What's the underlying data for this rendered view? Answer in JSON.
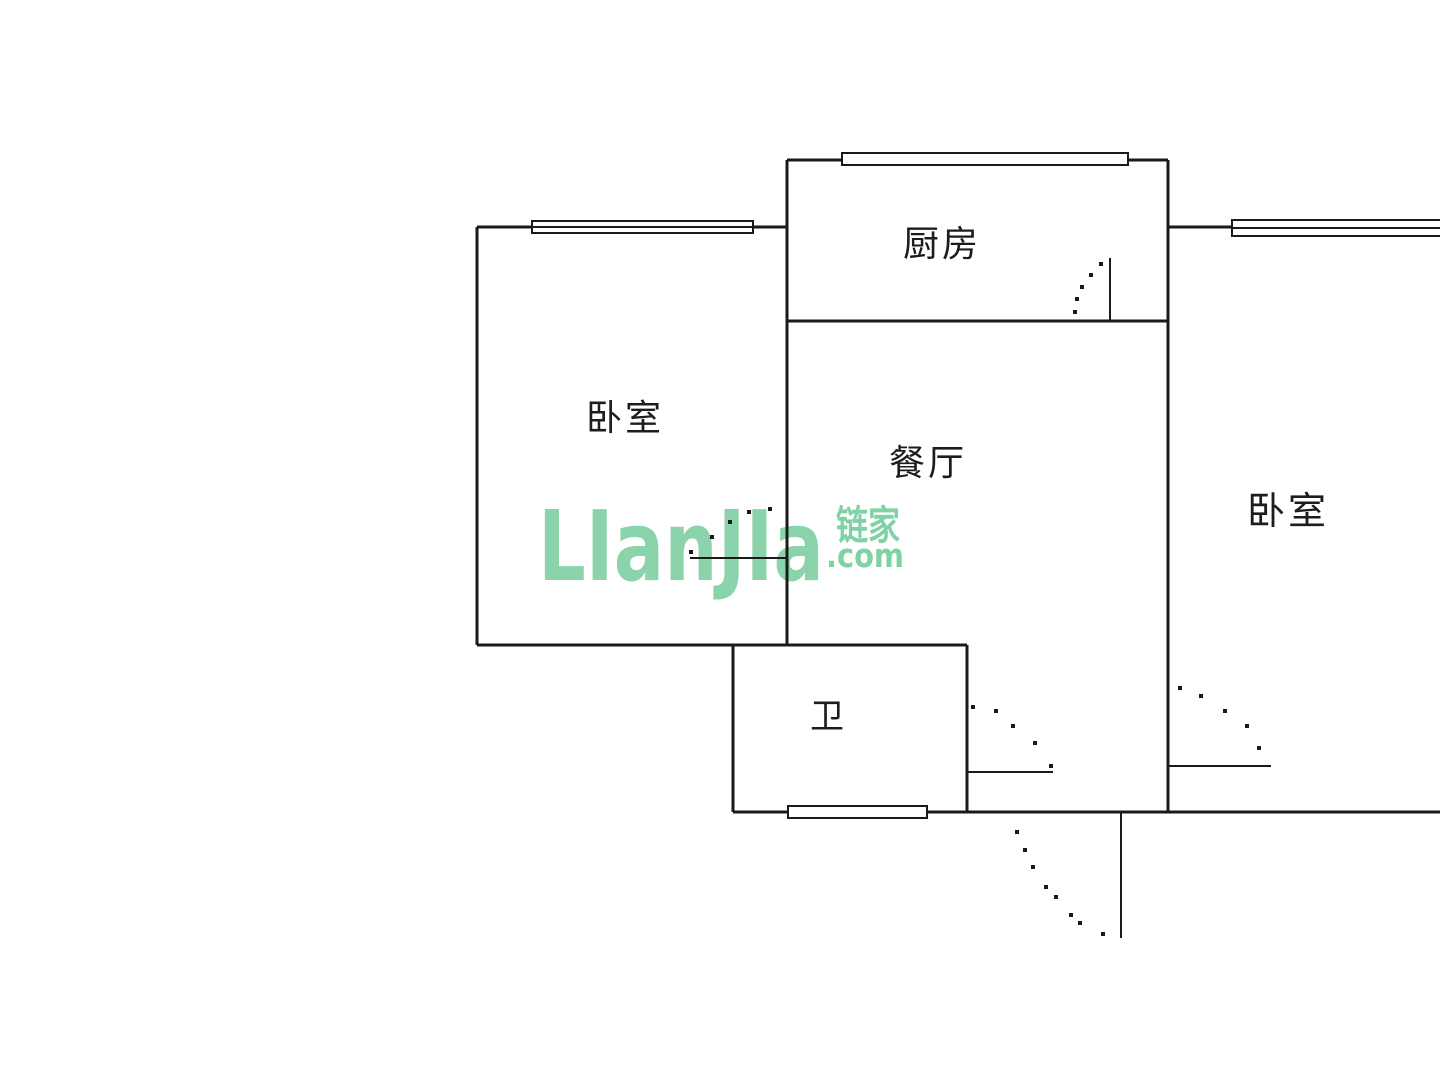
{
  "canvas": {
    "width": 1440,
    "height": 1080,
    "background": "#ffffff",
    "line_color": "#1a1a1a",
    "wall_stroke": 3,
    "window_stroke": 2,
    "door_stroke": 2,
    "dot_size": 4
  },
  "rooms": [
    {
      "id": "kitchen",
      "label": "厨房"
    },
    {
      "id": "bedroom-left",
      "label": "卧室"
    },
    {
      "id": "dining",
      "label": "餐厅"
    },
    {
      "id": "bedroom-right",
      "label": "卧室"
    },
    {
      "id": "bathroom",
      "label": "卫"
    }
  ],
  "walls": [
    {
      "x1": 787,
      "y1": 160,
      "x2": 1168,
      "y2": 160
    },
    {
      "x1": 477,
      "y1": 227,
      "x2": 787,
      "y2": 227
    },
    {
      "x1": 1168,
      "y1": 227,
      "x2": 1440,
      "y2": 227
    },
    {
      "x1": 787,
      "y1": 321,
      "x2": 1168,
      "y2": 321
    },
    {
      "x1": 477,
      "y1": 645,
      "x2": 967,
      "y2": 645
    },
    {
      "x1": 733,
      "y1": 812,
      "x2": 1440,
      "y2": 812
    },
    {
      "x1": 477,
      "y1": 227,
      "x2": 477,
      "y2": 645
    },
    {
      "x1": 787,
      "y1": 160,
      "x2": 787,
      "y2": 645
    },
    {
      "x1": 1168,
      "y1": 160,
      "x2": 1168,
      "y2": 812
    },
    {
      "x1": 733,
      "y1": 645,
      "x2": 733,
      "y2": 812
    },
    {
      "x1": 967,
      "y1": 645,
      "x2": 967,
      "y2": 812
    }
  ],
  "windows": [
    {
      "id": "kitchen-window",
      "x": 842,
      "cy": 159,
      "w": 286,
      "hh": 6,
      "mid": false
    },
    {
      "id": "bedroom-left-window",
      "x": 532,
      "cy": 227,
      "w": 221,
      "hh": 6,
      "mid": true
    },
    {
      "id": "bedroom-right-window",
      "x": 1232,
      "cy": 228,
      "w": 210,
      "hh": 8,
      "mid": true
    },
    {
      "id": "bathroom-window",
      "x": 788,
      "cy": 812,
      "w": 139,
      "hh": 6,
      "mid": false
    }
  ],
  "doors": [
    {
      "id": "bedroom-left-door",
      "leaf": {
        "x1": 690,
        "y1": 558,
        "x2": 787,
        "y2": 558
      },
      "dots": [
        [
          691,
          552
        ],
        [
          712,
          537
        ],
        [
          730,
          522
        ],
        [
          749,
          512
        ],
        [
          770,
          509
        ]
      ]
    },
    {
      "id": "kitchen-door",
      "leaf": {
        "x1": 1110,
        "y1": 258,
        "x2": 1110,
        "y2": 321
      },
      "dots": [
        [
          1101,
          264
        ],
        [
          1091,
          275
        ],
        [
          1082,
          287
        ],
        [
          1077,
          299
        ],
        [
          1075,
          312
        ]
      ]
    },
    {
      "id": "bathroom-door",
      "leaf": {
        "x1": 967,
        "y1": 772,
        "x2": 1053,
        "y2": 772
      },
      "dots": [
        [
          973,
          707
        ],
        [
          996,
          711
        ],
        [
          1013,
          726
        ],
        [
          1035,
          743
        ],
        [
          1051,
          766
        ]
      ]
    },
    {
      "id": "bedroom-right-door",
      "leaf": {
        "x1": 1168,
        "y1": 766,
        "x2": 1271,
        "y2": 766
      },
      "dots": [
        [
          1180,
          688
        ],
        [
          1201,
          696
        ],
        [
          1225,
          711
        ],
        [
          1247,
          726
        ],
        [
          1259,
          748
        ]
      ]
    },
    {
      "id": "entry-door",
      "leaf": {
        "x1": 1121,
        "y1": 812,
        "x2": 1121,
        "y2": 938
      },
      "dots": [
        [
          1017,
          832
        ],
        [
          1025,
          850
        ],
        [
          1033,
          867
        ],
        [
          1046,
          887
        ],
        [
          1056,
          897
        ],
        [
          1071,
          915
        ],
        [
          1080,
          923
        ],
        [
          1103,
          934
        ]
      ]
    }
  ],
  "watermark": {
    "logo": "LIanJIa",
    "cn": "链家",
    "com": ".com",
    "logo_color": "#8bd4ab",
    "cn_color": "#7ed2a4",
    "com_color": "#7ed2a4"
  }
}
